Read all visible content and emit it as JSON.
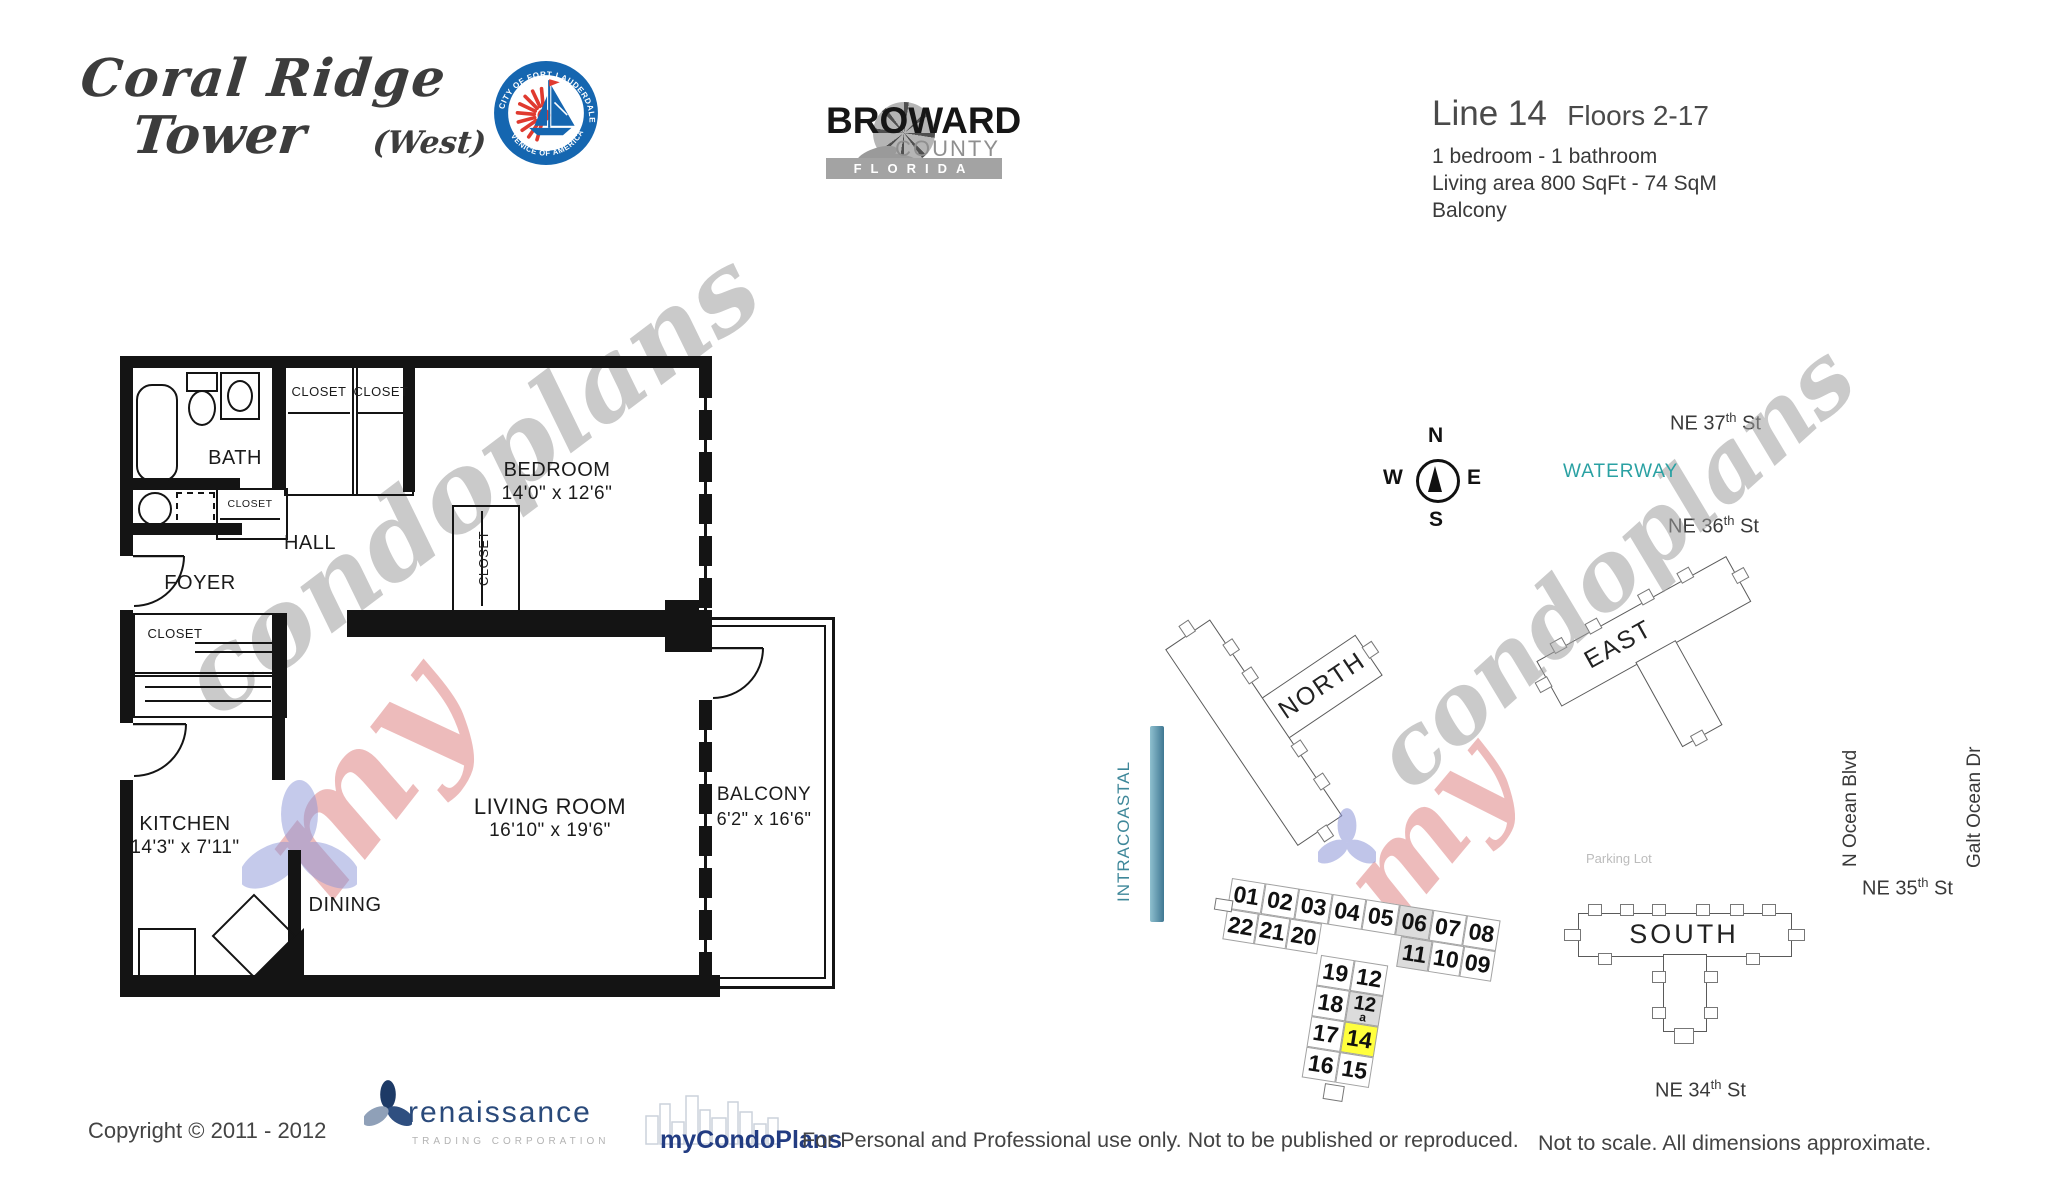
{
  "header": {
    "title_line1": "Coral Ridge",
    "title_line2": "Tower",
    "title_suffix": "(West)",
    "seal": {
      "arc_top": "CITY OF FORT LAUDERDALE",
      "arc_bottom": "VENICE OF AMERICA"
    },
    "broward": {
      "name": "BROWARD",
      "county": "COUNTY",
      "state": "FLORIDA"
    },
    "unit": {
      "line_label": "Line 14",
      "floors": "Floors 2-17",
      "bedrooms": "1 bedroom - 1 bathroom",
      "living_area": "Living area  800  SqFt - 74 SqM",
      "feature": "Balcony"
    }
  },
  "floor_plan": {
    "bath": "BATH",
    "closet": "CLOSET",
    "hall": "HALL",
    "foyer": "FOYER",
    "dining": "DINING",
    "bedroom": {
      "name": "BEDROOM",
      "dims": "14'0\" x 12'6\""
    },
    "kitchen": {
      "name": "KITCHEN",
      "dims": "14'3\" x 7'11\""
    },
    "living_room": {
      "name": "LIVING ROOM",
      "dims": "16'10\" x 19'6\""
    },
    "balcony": {
      "name": "BALCONY",
      "dims": "6'2\" x 16'6\""
    }
  },
  "site_map": {
    "compass": {
      "n": "N",
      "s": "S",
      "e": "E",
      "w": "W"
    },
    "waterway": "WATERWAY",
    "intracoastal": "INTRACOASTAL",
    "parking": "Parking Lot",
    "streets": {
      "ne37": {
        "name": "NE 37",
        "sup": "th",
        "suffix": " St"
      },
      "ne36": {
        "name": "NE 36",
        "sup": "th",
        "suffix": " St"
      },
      "ne35": {
        "name": "NE 35",
        "sup": "th",
        "suffix": " St"
      },
      "ne34": {
        "name": "NE 34",
        "sup": "th",
        "suffix": " St"
      },
      "ocean_blvd": "N Ocean Blvd",
      "galt_ocean": "Galt Ocean Dr"
    },
    "buildings": {
      "north": "NORTH",
      "east": "EAST",
      "south": "SOUTH"
    },
    "west_building": {
      "top_row": [
        "01",
        "02",
        "03",
        "04",
        "05",
        "06",
        "07",
        "08"
      ],
      "second_row_left": [
        "22",
        "21",
        "20"
      ],
      "second_row_right": [
        "11",
        "10",
        "09"
      ],
      "stem_left": [
        "19",
        "18",
        "17",
        "16"
      ],
      "stem_right": [
        "12",
        "12",
        "14",
        "15"
      ],
      "unit_12a_suffix": "a",
      "highlighted_unit": "14",
      "highlight_color": "#ffff3d"
    }
  },
  "watermark": {
    "part1": "my",
    "part2": "condoplans"
  },
  "footer": {
    "copyright": "Copyright © 2011 - 2012",
    "renaissance": {
      "name": "renaissance",
      "subtitle": "TRADING CORPORATION"
    },
    "mycondoplans": "myCondoPlans",
    "usage": "For Personal and Professional use only.  Not to be published or reproduced.",
    "disclaimer": "Not to scale.  All dimensions approximate."
  },
  "colors": {
    "teal": "#2aa1a3",
    "intracoastal_bar": "#4a7f9b",
    "highlight": "#ffff3d",
    "navy": "#223c82"
  }
}
